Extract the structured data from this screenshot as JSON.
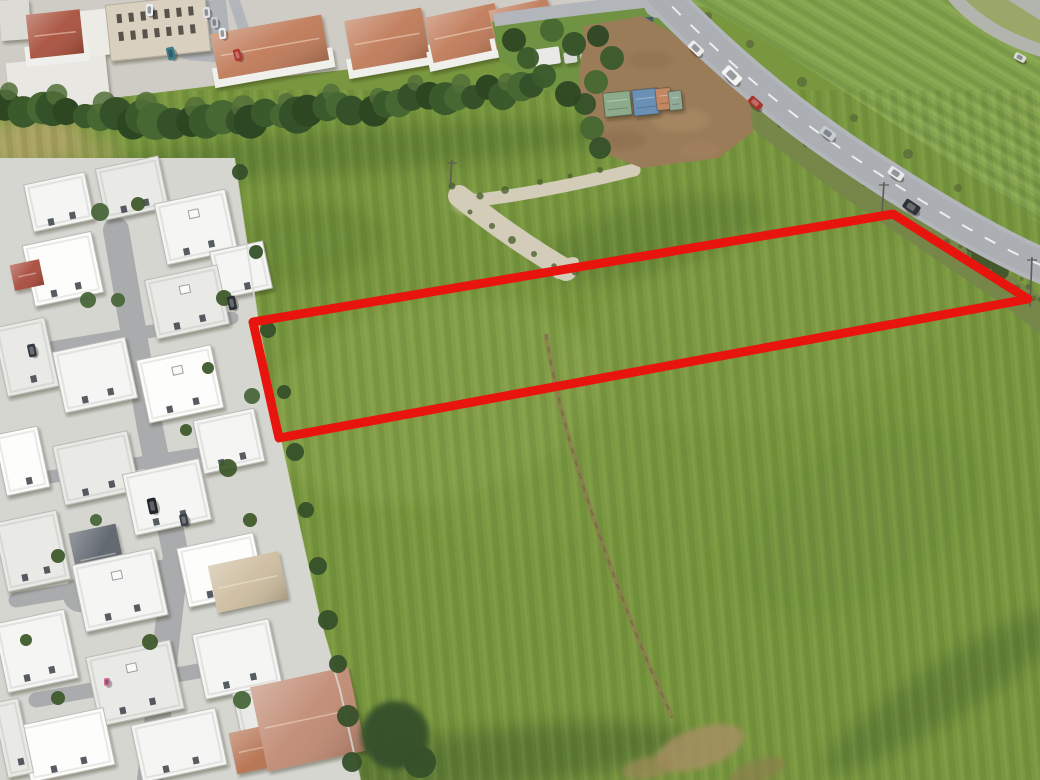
{
  "meta": {
    "description": "Aerial drone photograph of a rectangular land parcel outlined in red, set in a large green field beside a white residential housing estate, a tree hedge, a storage yard with shipping containers and a main road with passing cars",
    "width": 1040,
    "height": 780
  },
  "palette": {
    "field_base": "#79973f",
    "field_right": "#84a34e",
    "estate_base": "#d6d6d1",
    "urban_base": "#cfccc5",
    "road": "#b2b5b9",
    "road_inner": "#abaeb2",
    "gravel": "#d2ccb8",
    "dirt_yard": "#9b7c59",
    "scrub": "#75854a",
    "hedge_colors": [
      "#2e4723",
      "#3b5a2c",
      "#476832",
      "#35512a"
    ],
    "hedge_top": "#52703a",
    "tree": "#3c5227",
    "parcel_red": "#e8150f",
    "wall": "#dadbd5",
    "driveway": "#a9abad",
    "roof_terracotta": "#bf7a58",
    "roof_red": "#a8503c",
    "building_shades": [
      "#f5f5f3",
      "#e9eae6",
      "#fdfdfb",
      "#e2e3df"
    ],
    "corner_green": "#9aa768",
    "corner_gray": "#b2b4ae",
    "track": "#8d7c50",
    "dash_white": "#f4f4f2"
  },
  "parcel": {
    "points": [
      [
        253,
        322
      ],
      [
        893,
        214
      ],
      [
        1028,
        299
      ],
      [
        279,
        438
      ]
    ],
    "stroke_width": 9
  },
  "field": {
    "right_strip": [
      [
        672,
        0
      ],
      [
        1040,
        0
      ],
      [
        1040,
        224
      ],
      [
        952,
        162
      ],
      [
        866,
        106
      ],
      [
        780,
        50
      ],
      [
        708,
        8
      ]
    ],
    "corner_green": [
      [
        952,
        0
      ],
      [
        1040,
        0
      ],
      [
        1040,
        46
      ]
    ],
    "corner_gray": [
      [
        1008,
        0
      ],
      [
        1040,
        0
      ],
      [
        1040,
        20
      ]
    ],
    "patches": [
      [
        430,
        400,
        170,
        100,
        -12,
        "#9cb45e",
        0.26
      ],
      [
        760,
        330,
        200,
        90,
        -12,
        "#90a854",
        0.2
      ],
      [
        650,
        238,
        120,
        34,
        -14,
        "#4e6a2e",
        0.32
      ],
      [
        300,
        245,
        85,
        40,
        -8,
        "#55702f",
        0.28
      ],
      [
        540,
        470,
        120,
        70,
        -10,
        "#83a04e",
        0.25
      ],
      [
        860,
        520,
        140,
        80,
        -30,
        "#6d8c3e",
        0.3
      ],
      [
        500,
        758,
        190,
        30,
        -6,
        "#40582a",
        0.45
      ],
      [
        950,
        688,
        150,
        28,
        -33,
        "#44602e",
        0.4
      ],
      [
        360,
        150,
        260,
        22,
        -4,
        "#3f5c28",
        0.33
      ],
      [
        30,
        142,
        56,
        26,
        -6,
        "#b3a469",
        0.85
      ],
      [
        92,
        152,
        30,
        14,
        -6,
        "#b3a469",
        0.5
      ]
    ],
    "track_path": "M546,334 C560,430 606,560 642,648 C658,688 668,706 672,718",
    "dirt_patches": [
      [
        700,
        748,
        46,
        20,
        -18,
        "#a59062",
        0.85
      ],
      [
        648,
        768,
        26,
        11,
        -10,
        "#9c8858",
        0.7
      ],
      [
        757,
        772,
        30,
        12,
        -20,
        "#8f7c50",
        0.6
      ]
    ],
    "gravel_arm_long": "M459,196 C494,224 532,250 566,270",
    "gravel_arm_short": "M462,202 C520,196 578,184 634,170",
    "gravel_bushes": [
      [
        470,
        212
      ],
      [
        492,
        226
      ],
      [
        512,
        240
      ],
      [
        534,
        254
      ],
      [
        554,
        266
      ],
      [
        575,
        272
      ],
      [
        452,
        186
      ],
      [
        480,
        196
      ],
      [
        505,
        190
      ],
      [
        540,
        182
      ],
      [
        570,
        176
      ],
      [
        600,
        170
      ]
    ],
    "scrub": [
      [
        652,
        6
      ],
      [
        676,
        26
      ],
      [
        718,
        62
      ],
      [
        768,
        102
      ],
      [
        828,
        146
      ],
      [
        898,
        196
      ],
      [
        978,
        252
      ],
      [
        1040,
        296
      ],
      [
        1040,
        334
      ],
      [
        1002,
        304
      ],
      [
        916,
        246
      ],
      [
        836,
        192
      ],
      [
        766,
        140
      ],
      [
        710,
        92
      ],
      [
        664,
        50
      ],
      [
        638,
        22
      ]
    ],
    "scrub_spine": [
      [
        652,
        14
      ],
      [
        720,
        70
      ],
      [
        790,
        120
      ],
      [
        860,
        168
      ],
      [
        930,
        215
      ],
      [
        1000,
        262
      ],
      [
        1038,
        300
      ]
    ],
    "roadside_bushes": [
      [
        708,
        16,
        4
      ],
      [
        750,
        44,
        4
      ],
      [
        802,
        82,
        5
      ],
      [
        854,
        118,
        4
      ],
      [
        908,
        154,
        5
      ],
      [
        958,
        188,
        4
      ]
    ],
    "big_bushes": [
      [
        985,
        256,
        14
      ],
      [
        1000,
        271,
        9
      ],
      [
        973,
        245,
        8
      ]
    ],
    "poles": [
      [
        452,
        160,
        28
      ],
      [
        884,
        182,
        32
      ],
      [
        1032,
        257,
        50
      ]
    ]
  },
  "estate": {
    "base": [
      [
        0,
        158
      ],
      [
        234,
        158
      ],
      [
        258,
        322
      ],
      [
        280,
        438
      ],
      [
        302,
        540
      ],
      [
        320,
        620
      ],
      [
        340,
        690
      ],
      [
        360,
        780
      ],
      [
        0,
        780
      ]
    ],
    "driveways": [
      {
        "pts": [
          [
            116,
            230
          ],
          [
            150,
            428
          ],
          [
            176,
            556
          ],
          [
            160,
            700
          ],
          [
            150,
            780
          ]
        ],
        "w": 26
      },
      {
        "pts": [
          [
            26,
            352
          ],
          [
            232,
            318
          ]
        ],
        "w": 13
      },
      {
        "pts": [
          [
            30,
            480
          ],
          [
            212,
            452
          ]
        ],
        "w": 13
      },
      {
        "pts": [
          [
            16,
            600
          ],
          [
            196,
            570
          ]
        ],
        "w": 15
      },
      {
        "pts": [
          [
            36,
            700
          ],
          [
            204,
            670
          ]
        ],
        "w": 15
      },
      {
        "pts": [
          [
            80,
            595
          ],
          [
            185,
            572
          ]
        ],
        "w": 34
      }
    ],
    "buildings": [
      {
        "x": 28,
        "y": 178,
        "w": 62,
        "h": 48,
        "s": 0
      },
      {
        "x": 100,
        "y": 162,
        "w": 64,
        "h": 52,
        "s": 1
      },
      {
        "x": 160,
        "y": 196,
        "w": 72,
        "h": 62,
        "s": 0,
        "ac": 1
      },
      {
        "x": 28,
        "y": 238,
        "w": 70,
        "h": 62,
        "s": 2
      },
      {
        "x": 214,
        "y": 246,
        "w": 54,
        "h": 48,
        "s": 0
      },
      {
        "x": 150,
        "y": 272,
        "w": 74,
        "h": 60,
        "s": 1,
        "ac": 1
      },
      {
        "x": 12,
        "y": 262,
        "w": 30,
        "h": 26,
        "roof": "#a84b3c"
      },
      {
        "x": 0,
        "y": 322,
        "w": 52,
        "h": 70,
        "s": 1
      },
      {
        "x": 58,
        "y": 344,
        "w": 74,
        "h": 62,
        "s": 0
      },
      {
        "x": 142,
        "y": 352,
        "w": 76,
        "h": 64,
        "s": 2,
        "ac": 1
      },
      {
        "x": 198,
        "y": 414,
        "w": 62,
        "h": 54,
        "s": 0
      },
      {
        "x": 58,
        "y": 438,
        "w": 76,
        "h": 60,
        "s": 1
      },
      {
        "x": 0,
        "y": 430,
        "w": 44,
        "h": 62,
        "s": 2
      },
      {
        "x": 128,
        "y": 466,
        "w": 78,
        "h": 62,
        "s": 0
      },
      {
        "x": 74,
        "y": 528,
        "w": 48,
        "h": 58,
        "roof": "#5c636b"
      },
      {
        "x": 0,
        "y": 516,
        "w": 64,
        "h": 70,
        "s": 1
      },
      {
        "x": 78,
        "y": 556,
        "w": 84,
        "h": 68,
        "s": 0,
        "ac": 1
      },
      {
        "x": 182,
        "y": 540,
        "w": 78,
        "h": 60,
        "s": 2
      },
      {
        "x": 212,
        "y": 558,
        "w": 72,
        "h": 48,
        "roof": "#cdbd9f"
      },
      {
        "x": 0,
        "y": 616,
        "w": 72,
        "h": 70,
        "s": 0
      },
      {
        "x": 92,
        "y": 648,
        "w": 86,
        "h": 70,
        "s": 1,
        "ac": 1
      },
      {
        "x": 198,
        "y": 626,
        "w": 78,
        "h": 66,
        "s": 0
      },
      {
        "x": 24,
        "y": 716,
        "w": 86,
        "h": 58,
        "s": 2
      },
      {
        "x": 136,
        "y": 716,
        "w": 86,
        "h": 58,
        "s": 0
      },
      {
        "x": 0,
        "y": 700,
        "w": 26,
        "h": 76,
        "s": 1
      },
      {
        "x": 238,
        "y": 686,
        "w": 66,
        "h": 60,
        "s": 1
      },
      {
        "x": 232,
        "y": 724,
        "w": 84,
        "h": 42,
        "roof": "#b5714f"
      },
      {
        "x": 258,
        "y": 676,
        "w": 100,
        "h": 86,
        "roof": "#c08a72"
      }
    ],
    "trees": [
      [
        100,
        212,
        9
      ],
      [
        138,
        204,
        7
      ],
      [
        224,
        298,
        8
      ],
      [
        252,
        396,
        8
      ],
      [
        228,
        468,
        9
      ],
      [
        186,
        430,
        6
      ],
      [
        88,
        300,
        8
      ],
      [
        58,
        556,
        7
      ],
      [
        150,
        642,
        8
      ],
      [
        242,
        700,
        9
      ],
      [
        58,
        698,
        7
      ],
      [
        26,
        640,
        6
      ],
      [
        118,
        300,
        7
      ],
      [
        250,
        520,
        7
      ],
      [
        208,
        368,
        6
      ],
      [
        96,
        520,
        6
      ]
    ],
    "boundary_trees": [
      [
        240,
        172,
        8
      ],
      [
        256,
        252,
        7
      ],
      [
        268,
        330,
        8
      ],
      [
        284,
        392,
        7
      ],
      [
        295,
        452,
        9
      ],
      [
        306,
        510,
        8
      ],
      [
        318,
        566,
        9
      ],
      [
        328,
        620,
        10
      ],
      [
        338,
        664,
        9
      ],
      [
        348,
        716,
        11
      ],
      [
        352,
        762,
        10
      ],
      [
        395,
        735,
        34
      ],
      [
        420,
        762,
        16
      ]
    ],
    "cars": [
      [
        228,
        296,
        8,
        14,
        -12,
        "#2b3036"
      ],
      [
        28,
        344,
        8,
        13,
        -12,
        "#343a40"
      ],
      [
        148,
        498,
        9,
        16,
        -12,
        "#22262b"
      ],
      [
        180,
        514,
        8,
        12,
        -12,
        "#3a4046"
      ],
      [
        104,
        678,
        6,
        8,
        0,
        "#cf6f9d"
      ]
    ]
  },
  "urban": {
    "base": [
      [
        0,
        0
      ],
      [
        658,
        0
      ],
      [
        644,
        8
      ],
      [
        592,
        16
      ],
      [
        536,
        30
      ],
      [
        470,
        52
      ],
      [
        380,
        66
      ],
      [
        288,
        76
      ],
      [
        196,
        88
      ],
      [
        96,
        100
      ],
      [
        0,
        112
      ]
    ],
    "grass_strip": [
      [
        492,
        22
      ],
      [
        560,
        12
      ],
      [
        656,
        4
      ],
      [
        700,
        56
      ],
      [
        702,
        92
      ],
      [
        640,
        100
      ],
      [
        560,
        96
      ],
      [
        500,
        62
      ]
    ],
    "streets": [
      {
        "pts": [
          [
            150,
            -6
          ],
          [
            156,
            26
          ],
          [
            166,
            46
          ],
          [
            192,
            54
          ],
          [
            252,
            58
          ]
        ],
        "w": 13
      },
      {
        "pts": [
          [
            232,
            -6
          ],
          [
            244,
            30
          ],
          [
            256,
            56
          ]
        ],
        "w": 11
      }
    ],
    "parking_pad": [
      196,
      2,
      30,
      34,
      -6
    ],
    "white_blocks": [
      [
        0,
        0,
        30,
        40,
        "#dcdbd5",
        -4
      ],
      [
        8,
        58,
        100,
        50,
        "#e8e7e1",
        -6
      ],
      [
        74,
        10,
        38,
        46,
        "#ecebe5",
        -6
      ]
    ],
    "apartment": {
      "x": 108,
      "y": 0,
      "w": 100,
      "h": 56,
      "rot": -6,
      "fill": "#d9d0c0",
      "rows": 2,
      "cols": 7
    },
    "roof_houses": [
      {
        "x": 28,
        "y": 12,
        "w": 54,
        "h": 44,
        "rot": -6,
        "fill": "#a8503c"
      },
      {
        "x": 214,
        "y": 24,
        "w": 112,
        "h": 46,
        "rot": -10
      },
      {
        "x": 348,
        "y": 14,
        "w": 78,
        "h": 50,
        "rot": -10
      },
      {
        "x": 428,
        "y": 10,
        "w": 72,
        "h": 46,
        "rot": -12
      },
      {
        "x": 492,
        "y": 4,
        "w": 60,
        "h": 40,
        "rot": -12
      }
    ],
    "cars": [
      [
        146,
        4,
        7,
        12,
        0,
        "#eceff1"
      ],
      [
        203,
        7,
        7,
        11,
        -6,
        "#dfe2e4"
      ],
      [
        211,
        17,
        7,
        11,
        -6,
        "#c7cbcf"
      ],
      [
        219,
        28,
        7,
        11,
        -6,
        "#eceff1"
      ],
      [
        167,
        47,
        8,
        13,
        -14,
        "#3f7d8a"
      ],
      [
        234,
        49,
        7,
        12,
        -16,
        "#b13430"
      ]
    ],
    "hedge_line": [
      [
        10,
        108
      ],
      [
        80,
        118
      ],
      [
        200,
        122
      ],
      [
        320,
        112
      ],
      [
        450,
        97
      ],
      [
        535,
        86
      ]
    ],
    "hedge_count": 36,
    "cluster_trees": [
      [
        514,
        40,
        12
      ],
      [
        528,
        58,
        11
      ],
      [
        552,
        30,
        12
      ],
      [
        574,
        44,
        12
      ],
      [
        598,
        36,
        11
      ],
      [
        612,
        58,
        12
      ],
      [
        596,
        82,
        12
      ],
      [
        585,
        104,
        11
      ],
      [
        568,
        94,
        13
      ],
      [
        544,
        76,
        12
      ],
      [
        592,
        128,
        12
      ],
      [
        600,
        148,
        11
      ]
    ],
    "caravans": [
      [
        534,
        48,
        26,
        17,
        -8,
        "#e9e9e7"
      ],
      [
        564,
        52,
        13,
        11,
        -8,
        "#d9d9d5"
      ],
      [
        581,
        52,
        22,
        15,
        -8,
        "#f0f0ee"
      ]
    ],
    "fence": [
      640,
      18,
      13,
      26,
      -6,
      "#41586f"
    ]
  },
  "yard": {
    "polygon": [
      [
        584,
        26
      ],
      [
        642,
        16
      ],
      [
        668,
        30
      ],
      [
        712,
        62
      ],
      [
        750,
        100
      ],
      [
        753,
        132
      ],
      [
        718,
        158
      ],
      [
        642,
        168
      ],
      [
        596,
        150
      ],
      [
        578,
        92
      ]
    ],
    "mottles": [
      [
        620,
        140,
        26,
        10,
        "#8a6c4c",
        0.5
      ],
      [
        680,
        120,
        30,
        12,
        "#ad9068",
        0.5
      ],
      [
        650,
        60,
        22,
        9,
        "#8a6c4c",
        0.4
      ],
      [
        700,
        150,
        20,
        8,
        "#a5845f",
        0.5
      ]
    ],
    "containers": [
      [
        604,
        92,
        27,
        24,
        -6,
        "#8cab8a"
      ],
      [
        633,
        89,
        25,
        26,
        -6,
        "#6a90b5"
      ],
      [
        656,
        88,
        15,
        22,
        -6,
        "#c28763"
      ],
      [
        669,
        91,
        13,
        19,
        -6,
        "#90aa97"
      ]
    ]
  },
  "roads": {
    "main_path": "M654,-12 C700,36 766,98 846,152 C926,206 1002,250 1048,268",
    "main_width": 36,
    "side_path": "M494,20 C550,12 600,6 658,0",
    "side_width": 13,
    "ramp_path": "M950,-8 C968,16 1000,38 1046,52",
    "ramp_width": 13,
    "dash": "12 14",
    "cars": [
      [
        688,
        44,
        16,
        9,
        44,
        "#ebebe9"
      ],
      [
        722,
        70,
        20,
        11,
        44,
        "#f4f4f2"
      ],
      [
        748,
        99,
        15,
        8,
        42,
        "#a8322c"
      ],
      [
        820,
        129,
        16,
        9,
        36,
        "#c9cdd1"
      ],
      [
        888,
        169,
        16,
        9,
        34,
        "#e8e8e6"
      ],
      [
        903,
        202,
        17,
        10,
        34,
        "#2d3237"
      ],
      [
        1014,
        54,
        12,
        7,
        28,
        "#dcdcda"
      ]
    ]
  }
}
